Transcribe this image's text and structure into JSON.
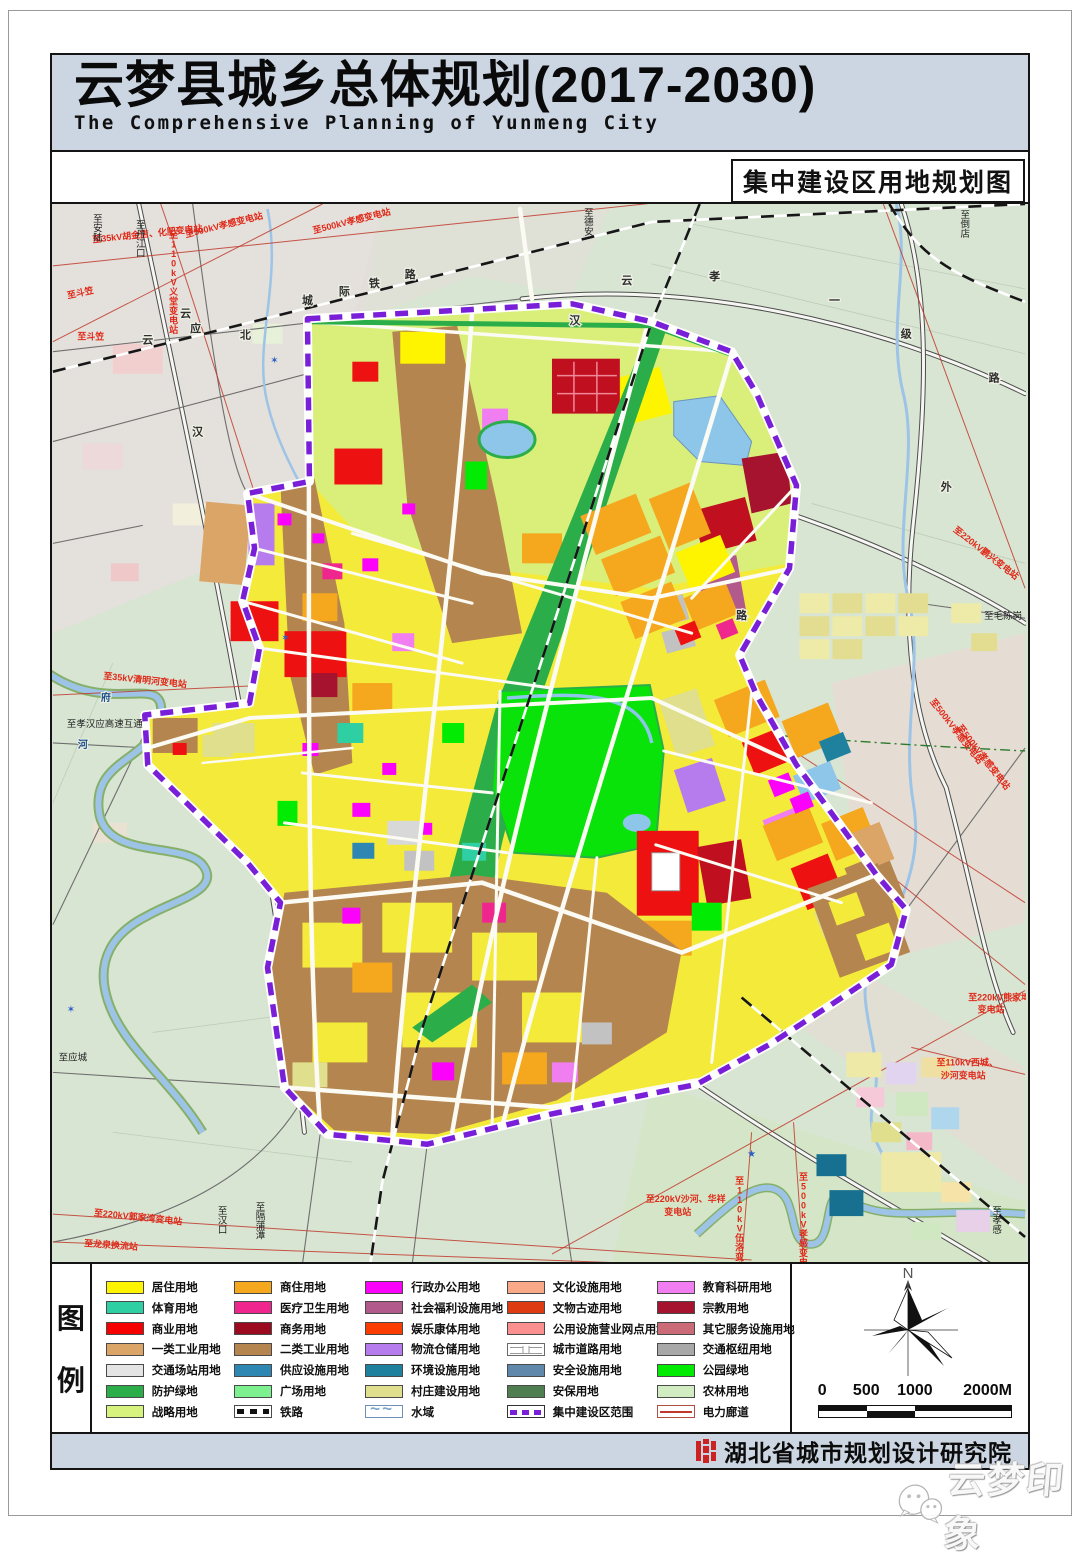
{
  "header": {
    "title": "云梦县城乡总体规划(2017-2030)",
    "subtitle": "The Comprehensive Planning of Yunmeng City",
    "map_label": "集中建设区用地规划图"
  },
  "legend": {
    "title_top": "图",
    "title_bottom": "例",
    "columns": [
      [
        {
          "label": "居住用地",
          "color": "#fef400"
        },
        {
          "label": "体育用地",
          "color": "#2ecfa2"
        },
        {
          "label": "商业用地",
          "color": "#f60000"
        },
        {
          "label": "一类工业用地",
          "color": "#dba567"
        },
        {
          "label": "交通场站用地",
          "color": "#e4e4e4"
        },
        {
          "label": "防护绿地",
          "color": "#2bae49"
        },
        {
          "label": "战略用地",
          "color": "#d8f27e"
        }
      ],
      [
        {
          "label": "商住用地",
          "color": "#f5a71e"
        },
        {
          "label": "医疗卫生用地",
          "color": "#f0268f"
        },
        {
          "label": "商务用地",
          "color": "#9c0a20"
        },
        {
          "label": "二类工业用地",
          "color": "#b5854f"
        },
        {
          "label": "供应设施用地",
          "color": "#2e86b3"
        },
        {
          "label": "广场用地",
          "color": "#7df08f"
        },
        {
          "label": "铁路",
          "type": "railway"
        }
      ],
      [
        {
          "label": "行政办公用地",
          "color": "#fb02fb"
        },
        {
          "label": "社会福利设施用地",
          "color": "#b35a8d"
        },
        {
          "label": "娱乐康体用地",
          "color": "#fb3d02"
        },
        {
          "label": "物流仓储用地",
          "color": "#b67cee"
        },
        {
          "label": "环境设施用地",
          "color": "#20819f"
        },
        {
          "label": "村庄建设用地",
          "color": "#dfdf8d"
        },
        {
          "label": "水域",
          "type": "water"
        }
      ],
      [
        {
          "label": "文化设施用地",
          "color": "#faa988"
        },
        {
          "label": "文物古迹用地",
          "color": "#de3b13"
        },
        {
          "label": "公用设施营业网点用地",
          "color": "#fa9090"
        },
        {
          "label": "城市道路用地",
          "type": "road"
        },
        {
          "label": "安全设施用地",
          "color": "#5f88ab"
        },
        {
          "label": "安保用地",
          "color": "#4f7e51"
        },
        {
          "label": "集中建设区范围",
          "type": "boundary"
        }
      ],
      [
        {
          "label": "教育科研用地",
          "color": "#f17ef1"
        },
        {
          "label": "宗教用地",
          "color": "#a5132f"
        },
        {
          "label": "其它服务设施用地",
          "color": "#cb6b77"
        },
        {
          "label": "交通枢纽用地",
          "color": "#a8a8a8"
        },
        {
          "label": "公园绿地",
          "color": "#02eb02"
        },
        {
          "label": "农林用地",
          "color": "#d2ecc1"
        },
        {
          "label": "电力廊道",
          "type": "power"
        }
      ]
    ]
  },
  "compass": {
    "north": "N"
  },
  "scalebar": {
    "ticks": [
      "0",
      "500",
      "1000",
      "2000M"
    ]
  },
  "footer": {
    "institute": "湖北省城市规划设计研究院"
  },
  "watermark": {
    "text": "云梦印象"
  },
  "map": {
    "accent_colors": {
      "boundary": "#7a1fd8",
      "power_line": "#c0392b",
      "water": "#9dc4e6"
    },
    "red_labels": [
      {
        "t": "至35kV胡金店、化肥变电站",
        "x": 95,
        "y": 33,
        "r": -6
      },
      {
        "t": "至500kV孝感变电站",
        "x": 172,
        "y": 24,
        "r": -14
      },
      {
        "t": "至500kV孝感变电站",
        "x": 300,
        "y": 20,
        "r": -14
      },
      {
        "t": "至110kV义堂变电站",
        "x": 121,
        "y": 34,
        "v": 1
      },
      {
        "t": "至斗笠",
        "x": 28,
        "y": 92,
        "r": -12
      },
      {
        "t": "至斗笠",
        "x": 38,
        "y": 136
      },
      {
        "t": "至35kV清明河变电站",
        "x": 92,
        "y": 480,
        "r": 6
      },
      {
        "t": "至220kV鹏兴变电站",
        "x": 933,
        "y": 352,
        "r": 38
      },
      {
        "t": "至500kV孝感变电站",
        "x": 903,
        "y": 530,
        "r": 52
      },
      {
        "t": "至500kV孝感变电站",
        "x": 930,
        "y": 556,
        "r": 52
      },
      {
        "t": "至220kV熊家塆",
        "x": 948,
        "y": 798
      },
      {
        "t": "变电站",
        "x": 940,
        "y": 810
      },
      {
        "t": "至110kV西城、",
        "x": 916,
        "y": 863
      },
      {
        "t": "沙河变电站",
        "x": 912,
        "y": 876
      },
      {
        "t": "至220kV沙河、华祥",
        "x": 634,
        "y": 1000
      },
      {
        "t": "变电站",
        "x": 626,
        "y": 1013
      },
      {
        "t": "至110kV伍洛变电站",
        "x": 688,
        "y": 982,
        "v": 1
      },
      {
        "t": "至500kV孝感变电站",
        "x": 752,
        "y": 978,
        "v": 1
      },
      {
        "t": "至220kV郭家湾变电站",
        "x": 85,
        "y": 1018,
        "r": 6
      },
      {
        "t": "至龙泉换流站",
        "x": 58,
        "y": 1046,
        "r": 4
      }
    ],
    "black_labels": [
      {
        "t": "至安陆",
        "x": 45,
        "y": 18,
        "v": 1
      },
      {
        "t": "至丹江口",
        "x": 88,
        "y": 24,
        "v": 1
      },
      {
        "t": "至德安",
        "x": 537,
        "y": 12,
        "v": 1
      },
      {
        "t": "至倒店",
        "x": 914,
        "y": 14,
        "v": 1
      },
      {
        "t": "至毛陈岗",
        "x": 952,
        "y": 416
      },
      {
        "t": "至孝汉应高速互通",
        "x": 52,
        "y": 524
      },
      {
        "t": "至应城",
        "x": 20,
        "y": 858
      },
      {
        "t": "至汉口",
        "x": 170,
        "y": 1012,
        "v": 1
      },
      {
        "t": "至隔蒲潭",
        "x": 208,
        "y": 1008,
        "v": 1
      },
      {
        "t": "至孝感",
        "x": 946,
        "y": 1012,
        "v": 1
      }
    ],
    "railway_chars": [
      {
        "t": "云",
        "x": 95,
        "y": 140
      },
      {
        "t": "应",
        "x": 143,
        "y": 128
      },
      {
        "t": "城",
        "x": 255,
        "y": 100
      },
      {
        "t": "际",
        "x": 292,
        "y": 91
      },
      {
        "t": "铁",
        "x": 322,
        "y": 83
      },
      {
        "t": "路",
        "x": 358,
        "y": 74
      }
    ],
    "road_chars": [
      {
        "t": "云",
        "x": 133,
        "y": 113
      },
      {
        "t": "北",
        "x": 193,
        "y": 135
      },
      {
        "t": "汉",
        "x": 145,
        "y": 232
      },
      {
        "t": "汉",
        "x": 523,
        "y": 120
      },
      {
        "t": "云",
        "x": 575,
        "y": 80
      },
      {
        "t": "孝",
        "x": 663,
        "y": 76
      },
      {
        "t": "一",
        "x": 783,
        "y": 100
      },
      {
        "t": "级",
        "x": 855,
        "y": 134
      },
      {
        "t": "路",
        "x": 943,
        "y": 178
      },
      {
        "t": "外",
        "x": 895,
        "y": 287
      },
      {
        "t": "路",
        "x": 690,
        "y": 416
      }
    ],
    "river_chars": [
      {
        "t": "府",
        "x": 53,
        "y": 498
      },
      {
        "t": "河",
        "x": 30,
        "y": 545
      }
    ]
  }
}
